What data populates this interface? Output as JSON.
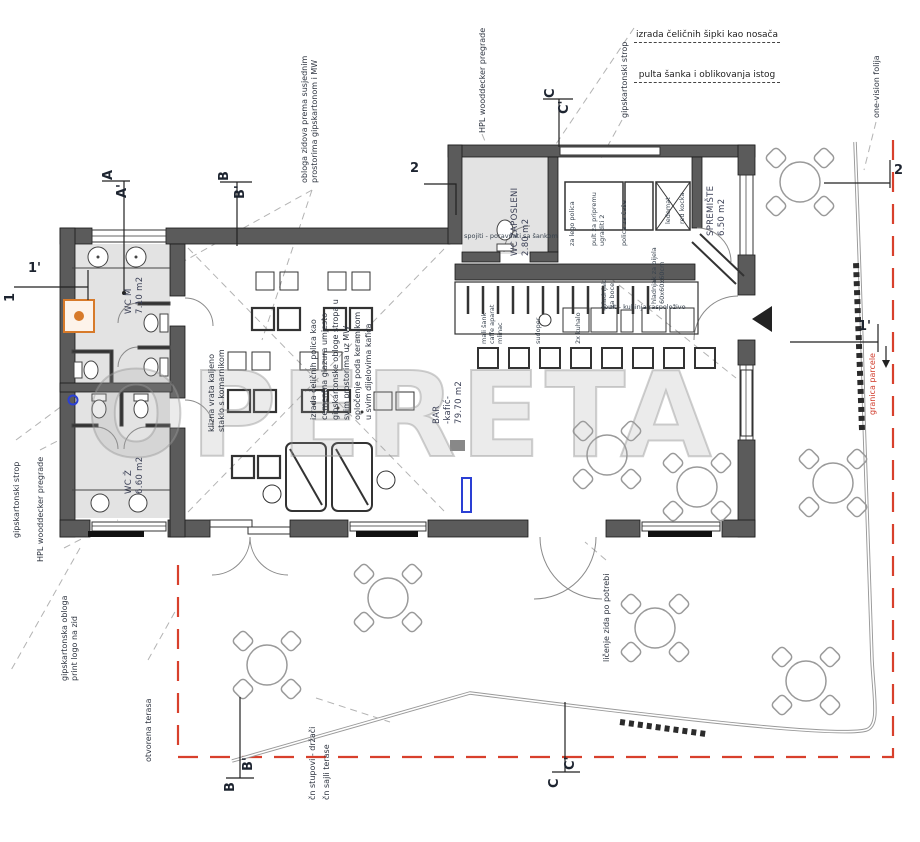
{
  "watermark": "OPERETA",
  "colors": {
    "wall": "#5b5b5b",
    "red": "#d8402c",
    "orange": "#d77a2a",
    "blue": "#2a3fd4"
  },
  "top_note": {
    "l1": "izrada čeličnih šipki kao nosača",
    "l2": "pulta šanka i oblikovanja istog"
  },
  "annotations": {
    "one_vision": "one-vision folija",
    "gips_strop_top": "gipskartonski strop",
    "hpl_top": "HPL wooddecker pregrade",
    "obloga": "obloga zidova prema susjednim\nprostorima gipskartonom i MW",
    "gips_strop_left": "gipskartonski strop",
    "hpl_left": "HPL wooddecker pregrade",
    "gips_obloga": "gipskartonska obloga\nprint logo na zid",
    "otvorena": "otvorena terasa",
    "stupovi": "čn stupovi - držači",
    "sajle": "čn sajli terase",
    "licenje": "ličenje zida po potrebi",
    "granica": "granica parcele",
    "klizna": "klizna vrata kaljeno\nstaklo s komarnikom",
    "spec": "izrada čeličnih polica kao\ncementna glazura umjesto\ngipskartonske obloge stropa u\nsvim prostorima uz MW\nopločenje poda keramikom\nu svim dijelovima kafića",
    "counter_note": "pult - kuhinja raspoloživo",
    "bar_top_note": "spojiti - poravnati sa šankom"
  },
  "rooms": {
    "wcm": "WC M\n7.10 m2",
    "wcz": "WC Ž\n6.60 m2",
    "wczap": "WC ZAPOSLENI\n2.80 m2",
    "sprem": "SPREMIŠTE\n6.50 m2",
    "bar": "BAR\n-kafić-\n79.70 m2"
  },
  "equipment": {
    "lego": "za lego polica",
    "pult": "pult za pripremu\nugraditi 2",
    "police": "polica za čaše",
    "ledomat": "ledomat",
    "kocka": "red kocka",
    "mali": "mali šank\ncaffe aparat\nmlinac",
    "sudoper": "sudoper",
    "kuhalo": "2x kuhalo",
    "hladnjak_boce": "hladnjak\nza boce",
    "hladnjak_vina": "hladnjak za bijela\n60x60x60cm"
  },
  "markers": {
    "a": "A",
    "ap": "A'",
    "b": "B",
    "bp": "B'",
    "c": "C",
    "cp": "C'",
    "n1": "1",
    "n1p": "1'",
    "n2": "2"
  }
}
